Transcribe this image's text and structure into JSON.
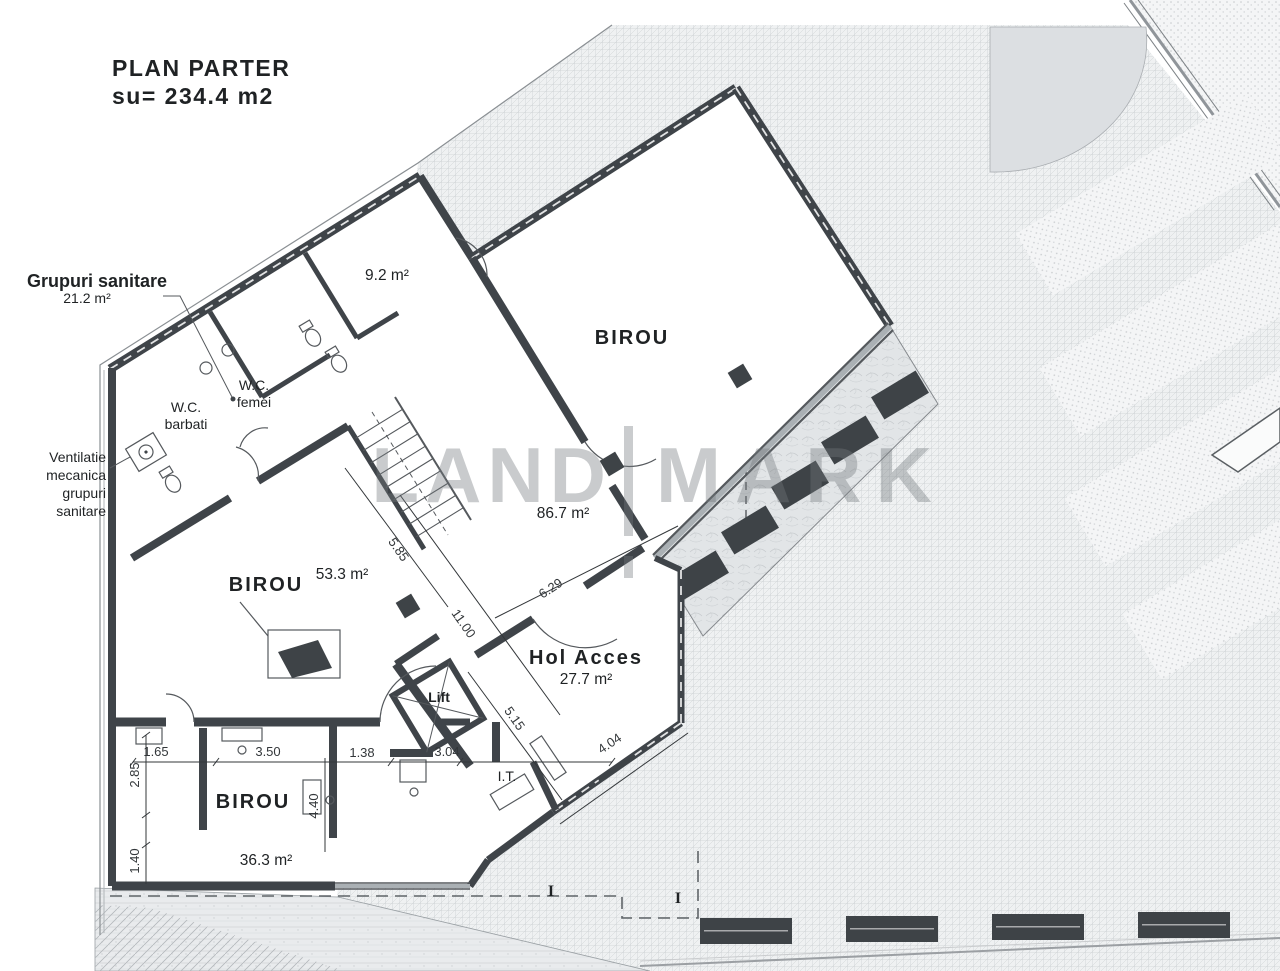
{
  "title": {
    "line1": "PLAN PARTER",
    "line2": "su= 234.4 m2"
  },
  "watermark": {
    "left": "LAND",
    "right": "MARK"
  },
  "labels": {
    "grupuri": {
      "name": "Grupuri sanitare",
      "area": "21.2 m²"
    },
    "ventilatie": {
      "line1": "Ventilatie",
      "line2": "mecanica",
      "line3": "grupuri",
      "line4": "sanitare"
    },
    "wc_femei": {
      "line1": "W.C.",
      "line2": "femei"
    },
    "wc_barbati": {
      "line1": "W.C.",
      "line2": "barbati"
    },
    "room92": {
      "area": "9.2 m²"
    },
    "birou_mare": {
      "name": "BIROU",
      "area": "86.7 m²"
    },
    "birou_rec": {
      "name": "BIROU",
      "area": "53.3 m²"
    },
    "birou_mic": {
      "name": "BIROU",
      "area": "36.3 m²"
    },
    "hol": {
      "name": "Hol Acces",
      "area": "27.7 m²"
    },
    "lift": {
      "name": "Lift"
    },
    "it": {
      "name": "I.T."
    }
  },
  "dims": {
    "d585": "5.85",
    "d1100": "11.00",
    "d629": "6.29",
    "d515": "5.15",
    "d404": "4.04",
    "d165": "1.65",
    "d350": "3.50",
    "d138": "1.38",
    "d304": "3.04",
    "d285": "2.85",
    "d440": "4.40",
    "d140": "1.40"
  },
  "markers": {
    "section": "I"
  },
  "colors": {
    "paper": "#ffffff",
    "wall": "#3f4449",
    "line": "#55595d",
    "text": "#1f2224",
    "dim_text": "#33373a",
    "watermark": "#74797d",
    "plaza_bg": "#eff1f2",
    "grid_line": "#bcc1c5",
    "dark_fixture": "#3e4347"
  }
}
